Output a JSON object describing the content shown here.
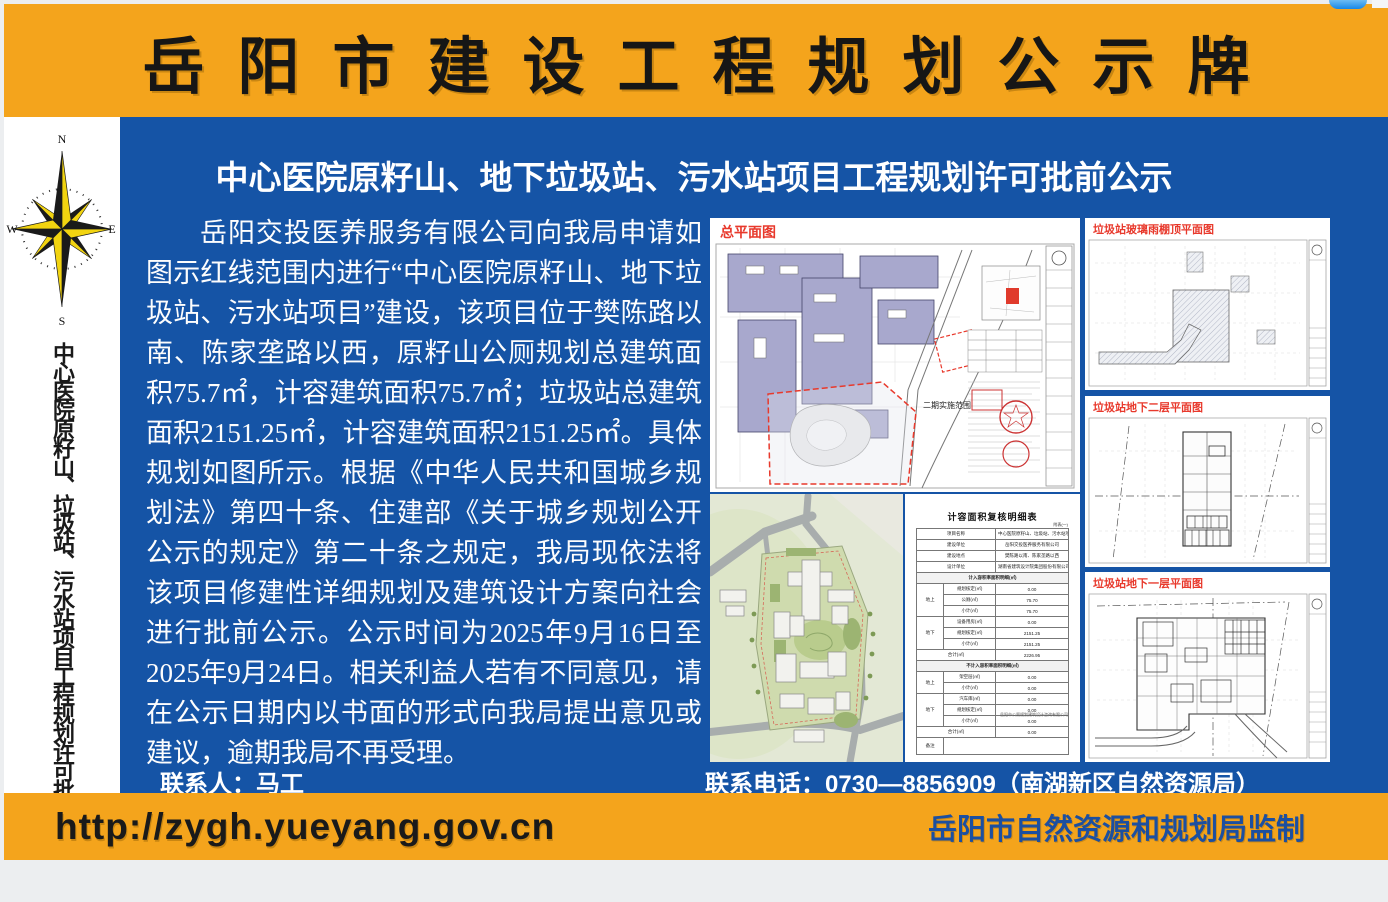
{
  "colors": {
    "orange": "#F4A41C",
    "blue": "#1554A6",
    "red_label": "#E8392C",
    "footer_url_color": "#1A1A1A",
    "footer_right_color": "#1C4FA0"
  },
  "header": {
    "title": "岳阳市建设工程规划公示牌"
  },
  "sidebar": {
    "compass": {
      "n": "N",
      "e": "E",
      "s": "S",
      "w": "W"
    },
    "vertical_title": "中心医院原籽山、垃圾站、污水站项目工程规划许可批前公示"
  },
  "main": {
    "title": "中心医院原籽山、地下垃圾站、污水站项目工程规划许可批前公示",
    "body": "岳阳交投医养服务有限公司向我局申请如图示红线范围内进行“中心医院原籽山、地下垃圾站、污水站项目”建设，该项目位于樊陈路以南、陈家垄路以西，原籽山公厕规划总建筑面积75.7㎡，计容建筑面积75.7㎡；垃圾站总建筑面积2151.25㎡，计容建筑面积2151.25㎡。具体规划如图所示。根据《中华人民共和国城乡规划法》第四十条、住建部《关于城乡规划公开公示的规定》第二十条之规定，我局现依法将该项目修建性详细规划及建筑设计方案向社会进行批前公示。公示时间为2025年9月16日至2025年9月24日。相关利益人若有不同意见，请在公示日期内以书面的形式向我局提出意见或建议，逾期我局不再受理。",
    "contact_person": "联系人：马工",
    "contact_phone": "联系电话：0730—8856909（南湖新区自然资源局）"
  },
  "panels": {
    "master": {
      "label": "总平面图",
      "annotation": "二期实施范围"
    },
    "roof": {
      "label": "垃圾站玻璃雨棚顶平面图"
    },
    "b2": {
      "label": "垃圾站地下二层平面图"
    },
    "b1": {
      "label": "垃圾站地下一层平面图"
    },
    "area_table": {
      "title": "计容面积复核明细表",
      "corner_note": "附表(一)",
      "footnote": "岳阳市公厕规划建筑设计咨询有限公司",
      "table_rows": [
        [
          {
            "t": "项目名称",
            "cs": 2
          },
          {
            "t": "中心医院原籽山、垃圾站、污水站项目"
          }
        ],
        [
          {
            "t": "建设单位",
            "cs": 2
          },
          {
            "t": "岳阳交投医养服务有限公司"
          }
        ],
        [
          {
            "t": "建设地点",
            "cs": 2
          },
          {
            "t": "樊陈路以南、陈家垄路以西"
          }
        ],
        [
          {
            "t": "设计单位",
            "cs": 2
          },
          {
            "t": "湖南省建筑设计院集团股份有限公司"
          }
        ],
        [
          {
            "t": "计入容积率面积明细(㎡)",
            "cs": 3,
            "c": "sec"
          }
        ],
        [
          {
            "t": "地上",
            "rs": 3
          },
          {
            "t": "规划核定(㎡)"
          },
          {
            "t": "0.00"
          }
        ],
        [
          {
            "t": "公厕(㎡)"
          },
          {
            "t": "75.70"
          }
        ],
        [
          {
            "t": "小计(㎡)"
          },
          {
            "t": "75.70"
          }
        ],
        [
          {
            "t": "地下",
            "rs": 3
          },
          {
            "t": "设备用房(㎡)"
          },
          {
            "t": "0.00"
          }
        ],
        [
          {
            "t": "规划核定(㎡)"
          },
          {
            "t": "2151.25"
          }
        ],
        [
          {
            "t": "小计(㎡)"
          },
          {
            "t": "2151.25"
          }
        ],
        [
          {
            "t": "合计(㎡)",
            "cs": 2
          },
          {
            "t": "2226.95"
          }
        ],
        [
          {
            "t": "不计入容积率面积明细(㎡)",
            "cs": 3,
            "c": "sec"
          }
        ],
        [
          {
            "t": "地上",
            "rs": 2
          },
          {
            "t": "架空层(㎡)"
          },
          {
            "t": "0.00"
          }
        ],
        [
          {
            "t": "小计(㎡)"
          },
          {
            "t": "0.00"
          }
        ],
        [
          {
            "t": "地下",
            "rs": 3
          },
          {
            "t": "汽车库(㎡)"
          },
          {
            "t": "0.00"
          }
        ],
        [
          {
            "t": "规划核定(㎡)"
          },
          {
            "t": "0.00"
          }
        ],
        [
          {
            "t": "小计(㎡)"
          },
          {
            "t": "0.00"
          }
        ],
        [
          {
            "t": "合计(㎡)",
            "cs": 2
          },
          {
            "t": "0.00"
          }
        ],
        [
          {
            "t": "备注"
          },
          {
            "t": "",
            "cs": 2,
            "c": "remark"
          }
        ]
      ]
    }
  },
  "footer": {
    "url": "http://zygh.yueyang.gov.cn",
    "right": "岳阳市自然资源和规划局监制"
  }
}
